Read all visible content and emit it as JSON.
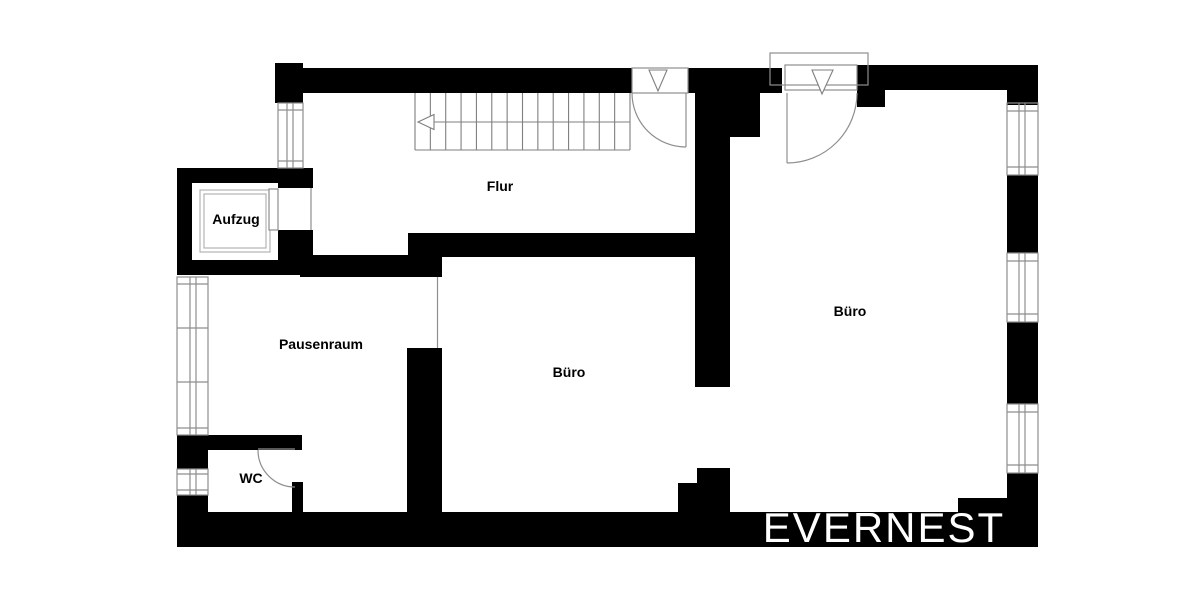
{
  "plan": {
    "labels": [
      {
        "id": "aufzug",
        "text": "Aufzug"
      },
      {
        "id": "flur",
        "text": "Flur"
      },
      {
        "id": "pausenraum",
        "text": "Pausenraum"
      },
      {
        "id": "buero-mitte",
        "text": "Büro"
      },
      {
        "id": "buero-rechts",
        "text": "Büro"
      },
      {
        "id": "wc",
        "text": "WC"
      }
    ],
    "watermark": {
      "text": "EVERNEST"
    },
    "colors": {
      "wall": "#000000",
      "background": "#ffffff",
      "thin_line": "#8e8e8e",
      "stair_line": "#7f7f7f",
      "label_text": "#000000",
      "watermark_text": "#ffffff"
    }
  }
}
